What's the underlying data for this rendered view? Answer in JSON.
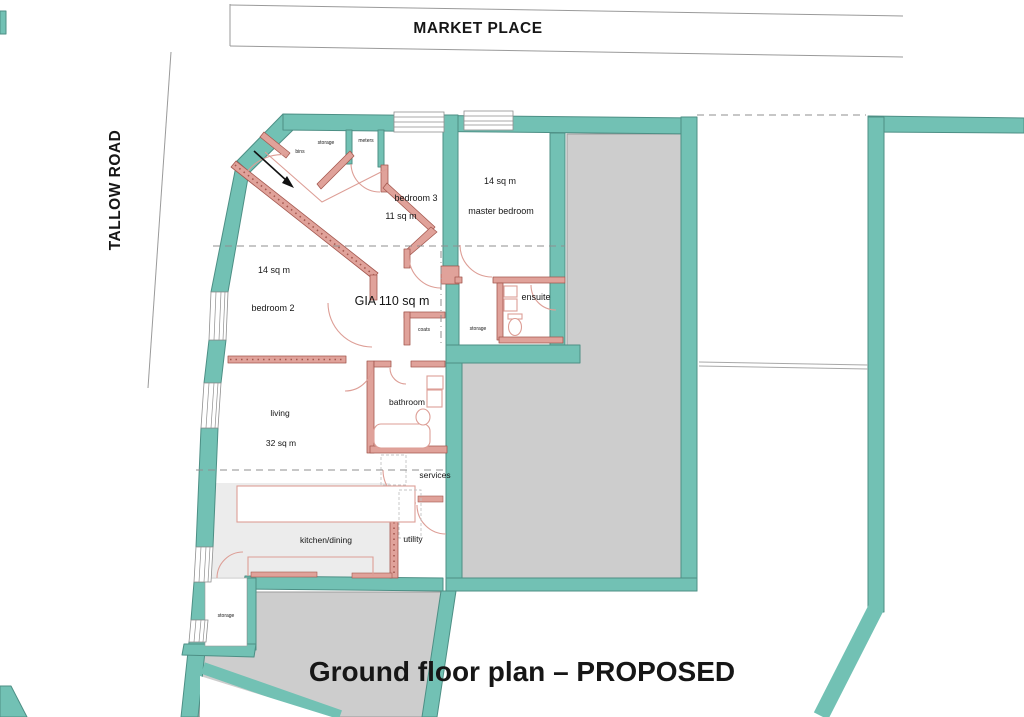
{
  "streets": {
    "market_place": "MARKET PLACE",
    "tallow_road": "TALLOW ROAD"
  },
  "title": "Ground floor plan – PROPOSED",
  "rooms": {
    "entrance": {
      "storage": "storage",
      "bins": "bins",
      "meters": "meters"
    },
    "bedroom3": {
      "name": "bedroom 3",
      "area": "11 sq m"
    },
    "master_bedroom": {
      "name": "master bedroom",
      "area": "14 sq m"
    },
    "bedroom2": {
      "name": "bedroom 2",
      "area": "14 sq m"
    },
    "hall": {
      "gia": "GIA 110 sq m",
      "coats": "coats",
      "storage": "storage"
    },
    "ensuite": {
      "name": "ensuite"
    },
    "bathroom": {
      "name": "bathroom"
    },
    "services": {
      "name": "services"
    },
    "living": {
      "name": "living",
      "area": "32 sq m"
    },
    "kitchen_dining": {
      "name": "kitchen/dining"
    },
    "utility": {
      "name": "utility"
    },
    "ground_storage": {
      "name": "storage"
    }
  },
  "colors": {
    "wall_teal": "#72c1b4",
    "wall_teal_stroke": "#4d8f85",
    "partition": "#e0a29a",
    "partition_stroke": "#a4584f",
    "neighbor_fill": "#cdcdcd",
    "neighbor_stroke": "#9b9b9b",
    "floor_fill": "#ececec",
    "fixture_pink": "#dd9e96",
    "dash_gray": "#8f8f8f",
    "street_line": "#9a9a9a",
    "text_color": "#161616"
  }
}
